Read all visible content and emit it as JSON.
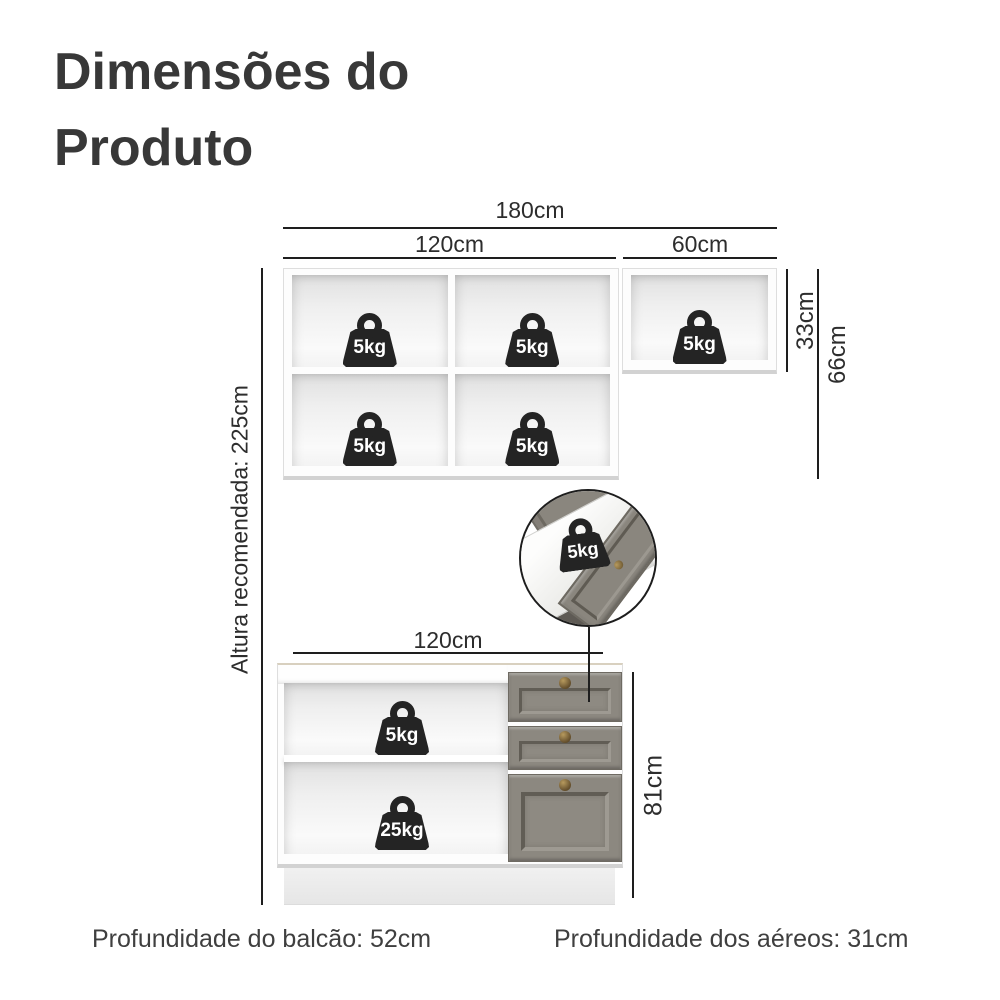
{
  "title": {
    "line1": "Dimensões do",
    "line2": "Produto"
  },
  "upper_cabinet": {
    "width_total_label": "180cm",
    "width_left_label": "120cm",
    "width_right_label": "60cm",
    "height_single_label": "33cm",
    "height_double_label": "66cm",
    "shelf_weights": [
      "5kg",
      "5kg",
      "5kg",
      "5kg",
      "5kg"
    ]
  },
  "drawer_inset": {
    "weight_label": "5kg"
  },
  "lower_cabinet": {
    "width_label": "120cm",
    "height_label": "81cm",
    "shelf_weights": [
      "5kg",
      "25kg"
    ]
  },
  "height_recommendation": {
    "label": "Altura recomendada: 225cm"
  },
  "footer": {
    "counter_depth": "Profundidade do balcão: 52cm",
    "wall_units_depth": "Profundidade dos aéreos: 31cm"
  },
  "colors": {
    "text": "#3b3b3b",
    "dimension_line": "#1e1e1e",
    "weight_icon": "#242424",
    "drawer_front": "#8c8880",
    "knob_bronze": "#8a7144",
    "background": "#ffffff"
  }
}
